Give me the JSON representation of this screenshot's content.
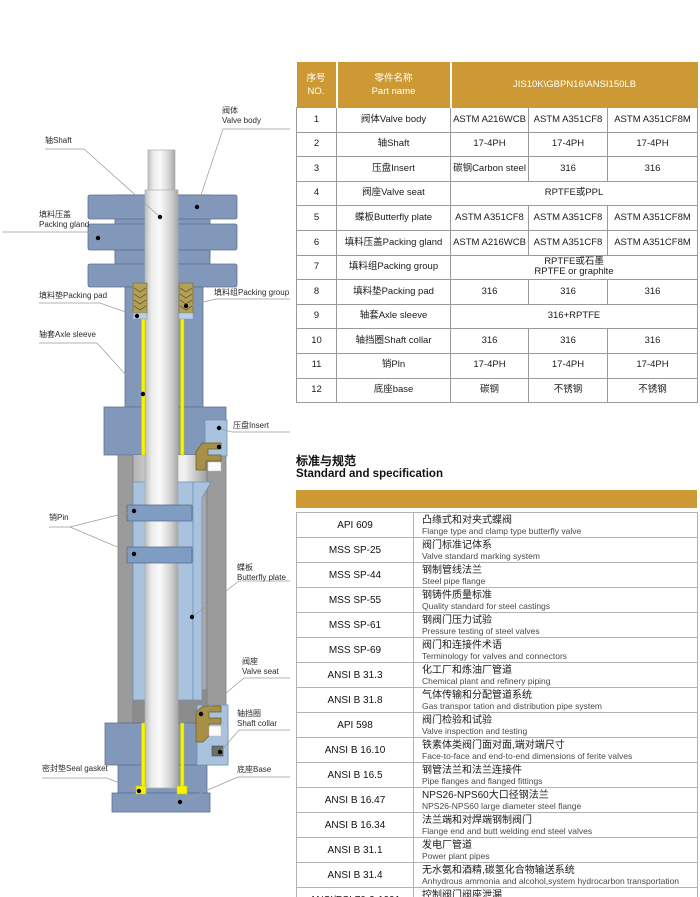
{
  "colors": {
    "header_gold": "#cd9934",
    "body_blue": "#8298ba",
    "light_blue": "#a9c3de",
    "pin_blue": "#7f9cc3",
    "housing_gray": "#9b9b9b",
    "packing_tan": "#b3a058",
    "insert_tan": "#a68f47",
    "sleeve_yellow": "#f7f400"
  },
  "diagram": {
    "labels": [
      {
        "id": "valve-body",
        "text": "阀体\nValve body"
      },
      {
        "id": "shaft",
        "text": "轴Shaft"
      },
      {
        "id": "packing-gland",
        "text": "填料压盖\nPacking gland"
      },
      {
        "id": "packing-pad",
        "text": "填料垫Packing pad"
      },
      {
        "id": "packing-group",
        "text": "填料组Packing group"
      },
      {
        "id": "axle-sleeve",
        "text": "轴套Axle sleeve"
      },
      {
        "id": "insert",
        "text": "压盘Insert"
      },
      {
        "id": "pin",
        "text": "销Pin"
      },
      {
        "id": "butterfly-plate",
        "text": "蝶板\nButterfly plate"
      },
      {
        "id": "valve-seat",
        "text": "阀座\nValve seat"
      },
      {
        "id": "shaft-collar",
        "text": "轴挡圈\nShaft collar"
      },
      {
        "id": "seal-gasket",
        "text": "密封垫Seal gasket"
      },
      {
        "id": "base",
        "text": "底座Base"
      }
    ]
  },
  "parts_table": {
    "header": {
      "no": "序号\nNO.",
      "part_name": "零件名称\nPart name",
      "materials": "JIS10K\\GBPN16\\ANSI150LB"
    },
    "rows": [
      {
        "no": "1",
        "name": "阀体Valve body",
        "materials": [
          "ASTM A216WCB",
          "ASTM A351CF8",
          "ASTM A351CF8M"
        ]
      },
      {
        "no": "2",
        "name": "轴Shaft",
        "materials": [
          "17-4PH",
          "17-4PH",
          "17-4PH"
        ]
      },
      {
        "no": "3",
        "name": "压盘Insert",
        "materials": [
          "碳钢Carbon steel",
          "316",
          "316"
        ]
      },
      {
        "no": "4",
        "name": "阀座Valve seat",
        "span": true,
        "materials": [
          "RPTFE或PPL"
        ]
      },
      {
        "no": "5",
        "name": "蝶板Butterfly plate",
        "materials": [
          "ASTM A351CF8",
          "ASTM A351CF8",
          "ASTM A351CF8M"
        ]
      },
      {
        "no": "6",
        "name": "填料压盖Packing gland",
        "materials": [
          "ASTM A216WCB",
          "ASTM A351CF8",
          "ASTM A351CF8M"
        ]
      },
      {
        "no": "7",
        "name": "填料组Packing group",
        "span": true,
        "materials": [
          "RPTFE或石墨\nRPTFE or graphlte"
        ]
      },
      {
        "no": "8",
        "name": "填料垫Packing pad",
        "materials": [
          "316",
          "316",
          "316"
        ]
      },
      {
        "no": "9",
        "name": "轴套Axle sleeve",
        "span": true,
        "materials": [
          "316+RPTFE"
        ]
      },
      {
        "no": "10",
        "name": "轴挡圈Shaft collar",
        "materials": [
          "316",
          "316",
          "316"
        ]
      },
      {
        "no": "11",
        "name": "销Pln",
        "materials": [
          "17-4PH",
          "17-4PH",
          "17-4PH"
        ]
      },
      {
        "no": "12",
        "name": "底座base",
        "materials": [
          "碳钢",
          "不锈钢",
          "不锈钢"
        ]
      }
    ]
  },
  "standards_table": {
    "title_zh": "标准与规范",
    "title_en": "Standard and specification",
    "rows": [
      {
        "code": "API 609",
        "zh": "凸缘式和对夹式蝶阀",
        "en": "Flange type and clamp type butterfly valve"
      },
      {
        "code": "MSS SP-25",
        "zh": "阀门标准记体系",
        "en": "Valve standard marking system"
      },
      {
        "code": "MSS SP-44",
        "zh": "钢制管线法兰",
        "en": "Steel pipe flange"
      },
      {
        "code": "MSS SP-55",
        "zh": "钢铸件质量标准",
        "en": "Quality standard for steel castings"
      },
      {
        "code": "MSS SP-61",
        "zh": "钢阀门压力试验",
        "en": "Pressure testing of steel valves"
      },
      {
        "code": "MSS SP-69",
        "zh": "阀门和连接件术语",
        "en": "Terminology for valves and connectors"
      },
      {
        "code": "ANSI B 31.3",
        "zh": "化工厂和炼油厂管道",
        "en": "Chemical plant and refinery piping"
      },
      {
        "code": "ANSI B 31.8",
        "zh": "气体传输和分配管道系统",
        "en": "Gas transpor tation and distribution pipe system"
      },
      {
        "code": "API 598",
        "zh": "阀门检验和试验",
        "en": "Valve inspection and testing"
      },
      {
        "code": "ANSI B 16.10",
        "zh": "铁素体类阀门面对面,端对端尺寸",
        "en": "Face-to-face and end-to-end dimensions of ferite valves"
      },
      {
        "code": "ANSI B 16.5",
        "zh": "钢管法兰和法兰连接件",
        "en": "Pipe flanges and flanged fittings"
      },
      {
        "code": "ANSI B 16.47",
        "zh": "NPS26-NPS60大口径钢法兰",
        "en": "NPS26-NPS60 large diameter steel flange"
      },
      {
        "code": "ANSI B 16.34",
        "zh": "法兰端和对焊端钢制阀门",
        "en": "Flange end and butt welding end steel valves"
      },
      {
        "code": "ANSI B 31.1",
        "zh": "发电厂管道",
        "en": "Power plant pipes"
      },
      {
        "code": "ANSI B 31.4",
        "zh": "无水氨和酒精,碳氢化合物输送系统",
        "en": "Anhydrous ammonia and alcohol,system hydrocarbon transportation"
      },
      {
        "code": "ANSI/FCI 70-2-1991",
        "zh": "控制阀门阀座泄漏",
        "en": "Control valve seat leakage"
      }
    ]
  }
}
